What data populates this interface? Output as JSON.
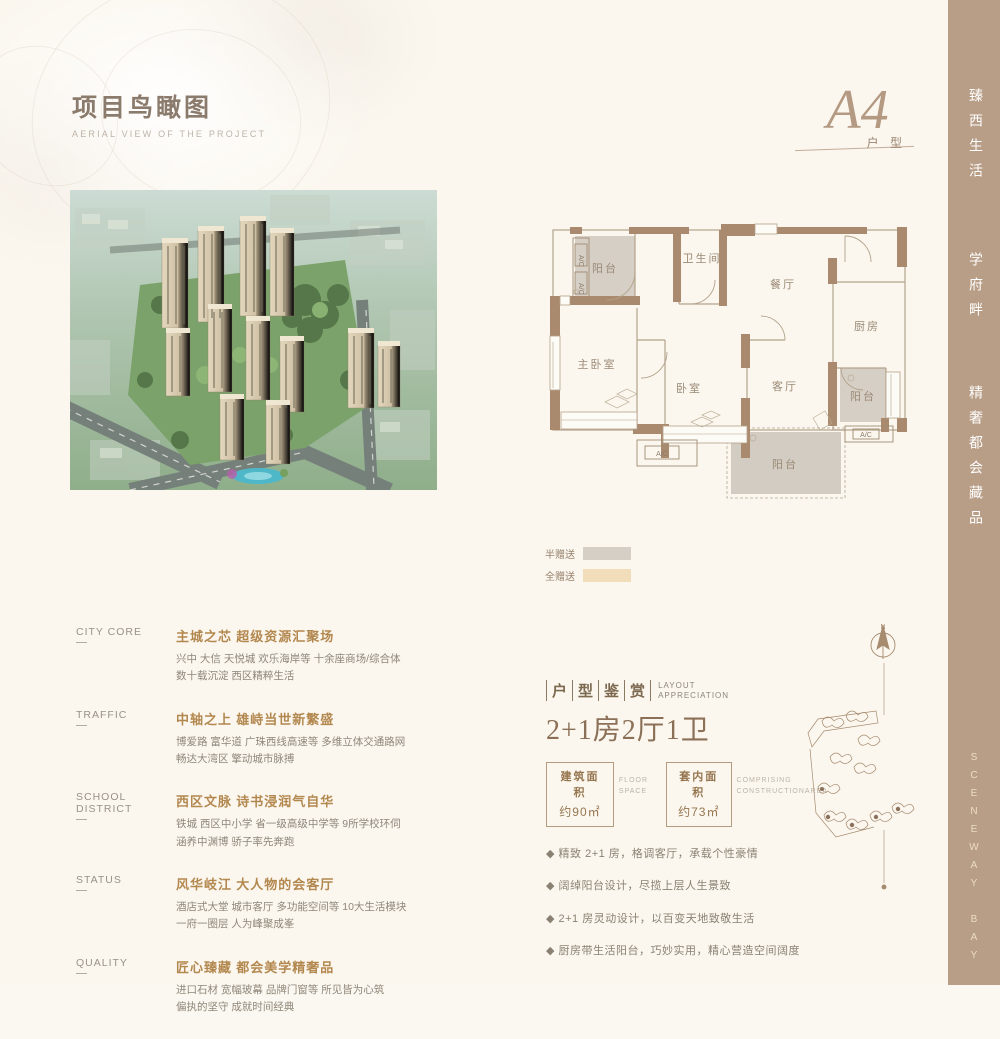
{
  "colors": {
    "page_bg": "#fbf7ef",
    "sidebar_tan": "#b89d87",
    "accent_brown": "#b3884f",
    "wall_brown": "#a98a6e",
    "gift_half_gray": "#d6cfc5",
    "gift_full_beige": "#f1ddba",
    "text_gray": "#8f8679"
  },
  "header": {
    "title": "项目鸟瞰图",
    "subtitle": "AERIAL VIEW OF THE PROJECT"
  },
  "emblem": {
    "code": "A4",
    "label": "户 型"
  },
  "sidebar": {
    "slogan1": "臻西生活",
    "slogan2": "学府畔",
    "slogan3": "精奢都会藏品",
    "brand": "SCENEWAY BAY"
  },
  "plan": {
    "rooms": {
      "balcony_top": "阳台",
      "bathroom": "卫生间",
      "dining": "餐厅",
      "kitchen": "厨房",
      "master_bedroom": "主卧室",
      "bedroom": "卧室",
      "living": "客厅",
      "balcony_right": "阳台",
      "balcony_bottom": "阳台",
      "ac1": "A/C",
      "ac2": "A/C",
      "ac3": "A/C",
      "ac4": "A/C"
    },
    "legend": [
      {
        "label": "半赠送",
        "color": "#d6cfc5"
      },
      {
        "label": "全赠送",
        "color": "#f1ddba"
      }
    ]
  },
  "info": {
    "sections": [
      {
        "label": "CITY  CORE",
        "heading": "主城之芯 超级资源汇聚场",
        "line1": "兴中 大信 天悦城 欢乐海岸等 十余座商场/综合体",
        "line2": "数十载沉淀 西区精粹生活"
      },
      {
        "label": "TRAFFIC",
        "heading": "中轴之上 雄峙当世新繁盛",
        "line1": "博爱路 富华道 广珠西线高速等 多维立体交通路网",
        "line2": "畅达大湾区 擎动城市脉搏"
      },
      {
        "label": "SCHOOL  DISTRICT",
        "heading": "西区文脉 诗书浸润气自华",
        "line1": "铁城 西区中小学 省一级高级中学等 9所学校环伺",
        "line2": "涵养中渊博 骄子率先奔跑"
      },
      {
        "label": "STATUS",
        "heading": "风华岐江 大人物的会客厅",
        "line1": "酒店式大堂 城市客厅 多功能空间等 10大生活模块",
        "line2": "一府一圈层 人为峰聚成峯"
      },
      {
        "label": "QUALITY",
        "heading": "匠心臻藏 都会美学精奢品",
        "line1": "进口石材 宽幅玻幕 品牌门窗等 所见皆为心筑",
        "line2": "偏执的坚守 成就时间经典"
      }
    ]
  },
  "layout": {
    "title_chars": [
      "户",
      "型",
      "鉴",
      "赏"
    ],
    "title_en1": "LAYOUT",
    "title_en2": "APPRECIATION",
    "headline": "2+1房2厅1卫",
    "areas": [
      {
        "label": "建筑面积",
        "value": "约90㎡",
        "note1": "FLOOR",
        "note2": "SPACE"
      },
      {
        "label": "套内面积",
        "value": "约73㎡",
        "note1": "COMPRISING",
        "note2": "CONSTRUCTIONAREA"
      }
    ],
    "bullets": [
      "◆ 精致 2+1 房，格调客厅，承载个性豪情",
      "◆ 阔绰阳台设计，尽揽上层人生景致",
      "◆ 2+1 房灵动设计，以百变天地致敬生活",
      "◆ 厨房带生活阳台，巧妙实用，精心营造空间阔度"
    ]
  },
  "sitemap": {
    "north": "N"
  }
}
